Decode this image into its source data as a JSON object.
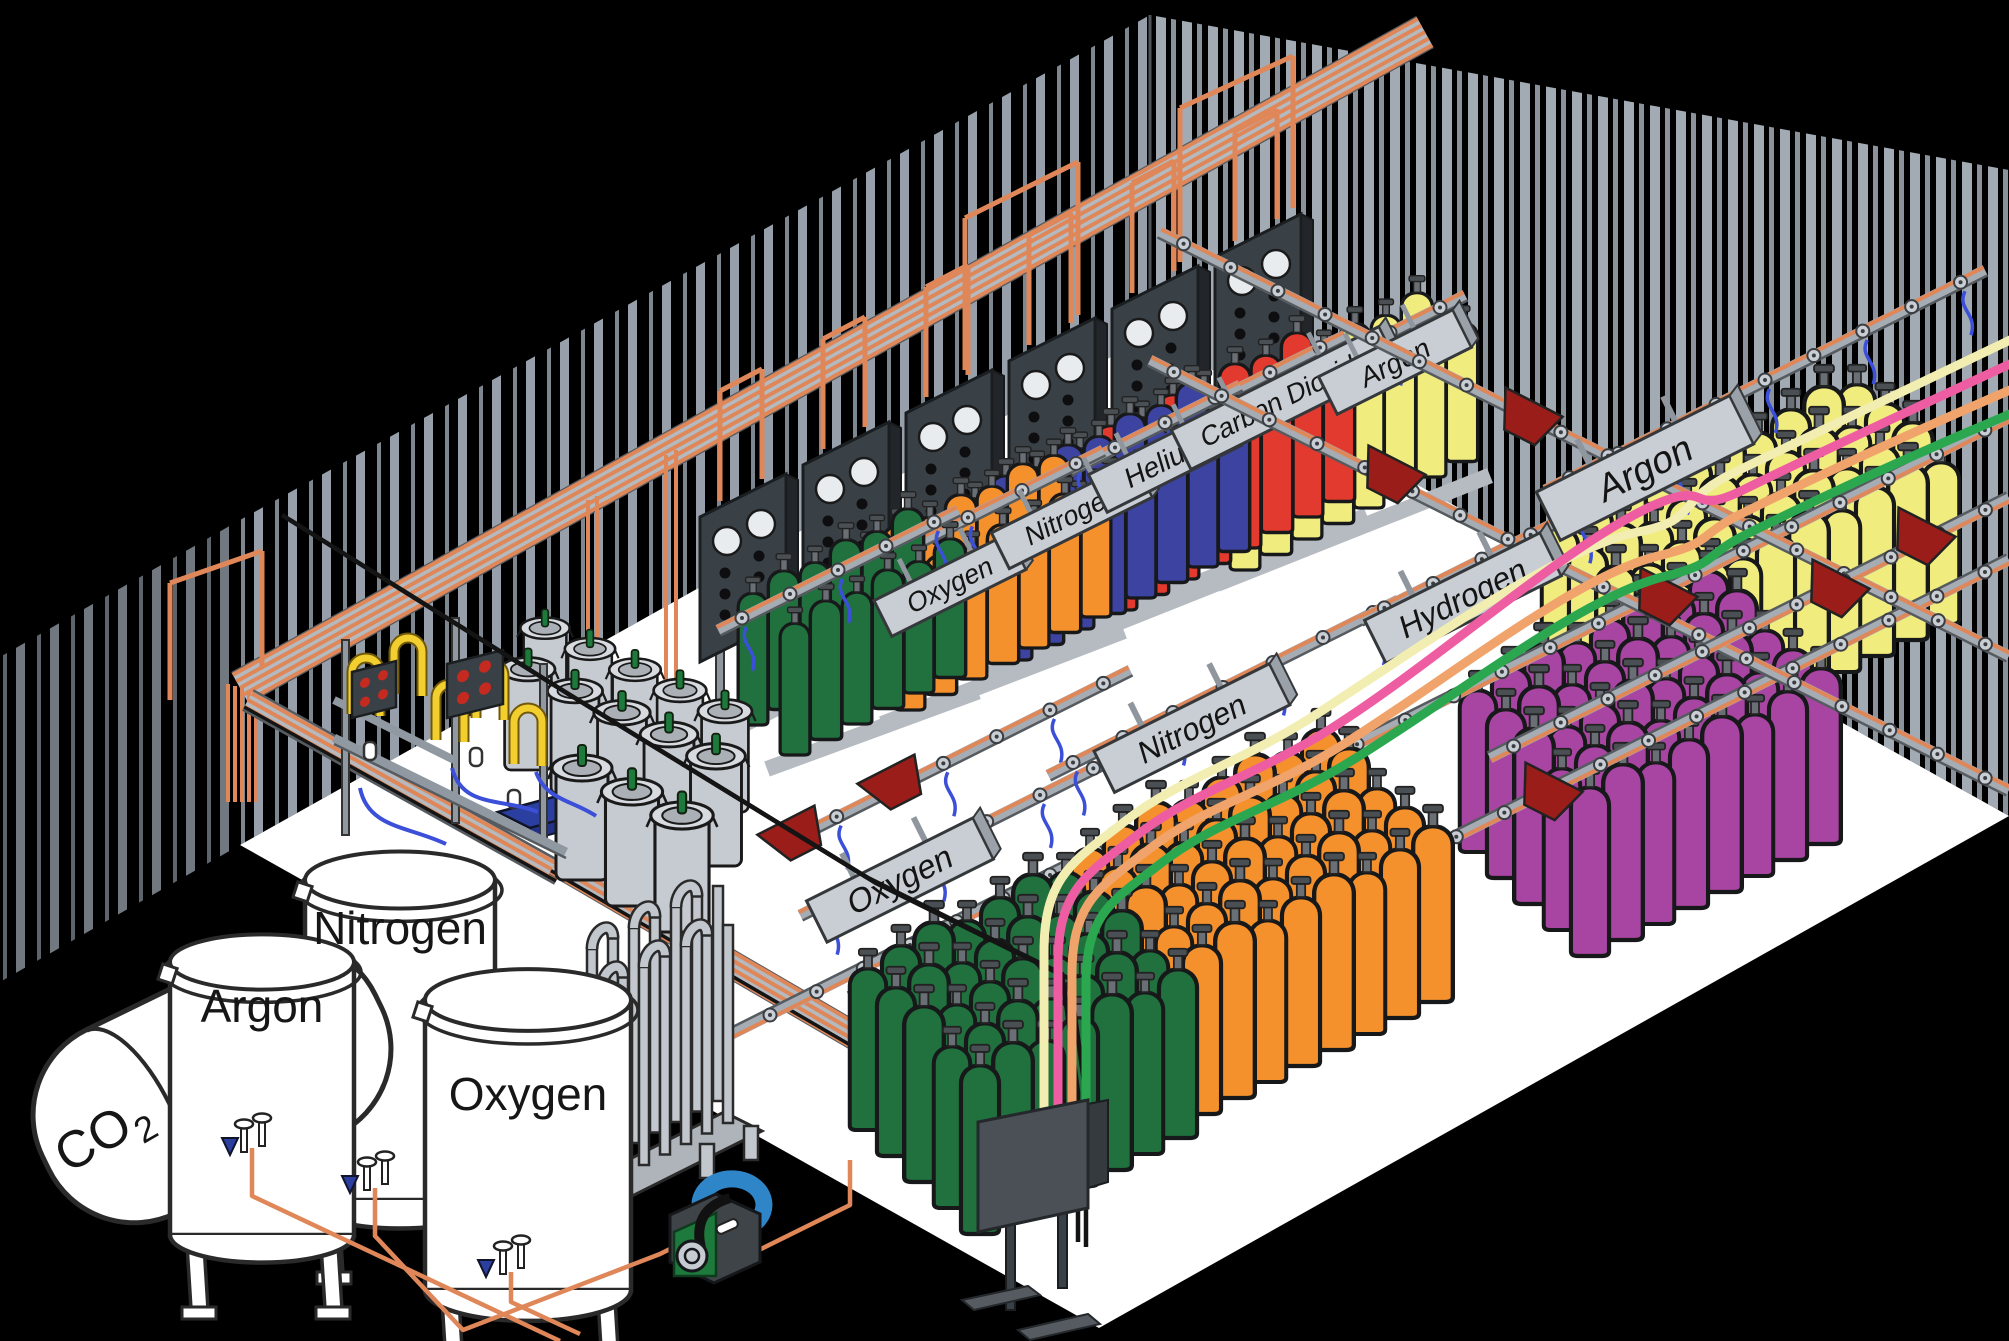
{
  "title": "Gas cylinder filling plant (isometric illustration)",
  "signs": {
    "argon_back": "Argon",
    "carbon_dioxide": "Carbon Dioxide",
    "helium": "Helium",
    "nitrogen_back": "Nitrogen",
    "oxygen_back": "Oxygen",
    "hydrogen": "Hydrogen",
    "nitrogen_front": "Nitrogen",
    "argon_right": "Argon",
    "oxygen_front": "Oxygen"
  },
  "storage_tanks": {
    "co2": {
      "formula_main": "CO",
      "formula_subscript": "2"
    },
    "argon": "Argon",
    "nitrogen": "Nitrogen",
    "oxygen": "Oxygen"
  },
  "cylinder_groups": [
    {
      "id": "carbon-dioxide-argon-rows",
      "label": "Carbon Dioxide",
      "color": "#F0EC7E",
      "count": 16
    },
    {
      "id": "helium-rows",
      "label": "Helium",
      "color": "#E23A2E",
      "count": 16
    },
    {
      "id": "nitrogen-rows",
      "label": "Nitrogen",
      "color": "#3D43A0",
      "count": 16
    },
    {
      "id": "oxygen-orange-rows",
      "label": "Oxygen",
      "color": "#F5912C",
      "count": 14
    },
    {
      "id": "oxygen-green-rows",
      "label": "Oxygen",
      "color": "#20713E",
      "count": 12
    },
    {
      "id": "argon-block",
      "label": "Argon",
      "color": "#F0EC7E",
      "count": 40
    },
    {
      "id": "hydrogen-block",
      "label": "Hydrogen",
      "color": "#A845A2",
      "count": 40
    },
    {
      "id": "orange-block",
      "label": "Nitrogen",
      "color": "#F5912C",
      "count": 40
    },
    {
      "id": "green-block",
      "label": "Oxygen",
      "color": "#20713E",
      "count": 35
    }
  ],
  "hoses": {
    "colors": [
      "#F2EDB0",
      "#EE5DA2",
      "#F0A46B",
      "#2BA84F"
    ]
  },
  "palette": {
    "wall_black": "#000000",
    "wall_stripe": "#9AA2AC",
    "floor_white": "#FF_FFFF_",
    "floor": "#FFFFFF",
    "copper_pipe": "#DF8758",
    "rail_gray": "#A6ACB3",
    "trolley_red": "#9B1D19",
    "pigtail_blue": "#3B4FD8",
    "panel_slate": "#3A4146",
    "dewar_gray": "#C6CBD1",
    "valve_green": "#1E7A3C",
    "hose_yellow": "#F2CE2E",
    "pump_blue": "#2E86C8",
    "indicator_red": "#C42A20"
  }
}
